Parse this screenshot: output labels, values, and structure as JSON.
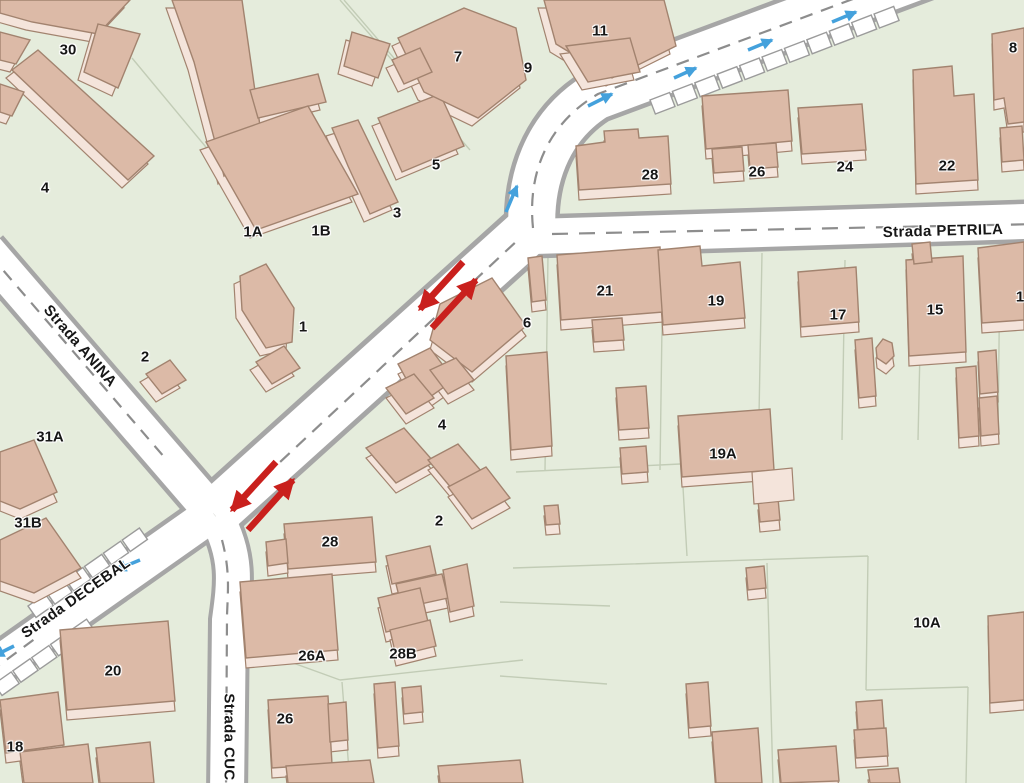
{
  "map": {
    "type": "street-map",
    "streets": {
      "anina": "Strada ANINA",
      "petrila": "Strada PETRILA",
      "decebal": "Strada DECEBAL",
      "cuc": "Strada CUC"
    },
    "building_labels": [
      {
        "t": "30",
        "x": 68,
        "y": 50
      },
      {
        "t": "4",
        "x": 45,
        "y": 188
      },
      {
        "t": "1A",
        "x": 253,
        "y": 232
      },
      {
        "t": "1B",
        "x": 321,
        "y": 231
      },
      {
        "t": "1",
        "x": 303,
        "y": 327
      },
      {
        "t": "2",
        "x": 145,
        "y": 357
      },
      {
        "t": "7",
        "x": 458,
        "y": 57
      },
      {
        "t": "9",
        "x": 528,
        "y": 68
      },
      {
        "t": "11",
        "x": 600,
        "y": 31
      },
      {
        "t": "5",
        "x": 436,
        "y": 165
      },
      {
        "t": "3",
        "x": 397,
        "y": 213
      },
      {
        "t": "28",
        "x": 650,
        "y": 175
      },
      {
        "t": "26",
        "x": 757,
        "y": 172
      },
      {
        "t": "24",
        "x": 845,
        "y": 167
      },
      {
        "t": "22",
        "x": 947,
        "y": 166
      },
      {
        "t": "8",
        "x": 1013,
        "y": 48
      },
      {
        "t": "6",
        "x": 527,
        "y": 323
      },
      {
        "t": "21",
        "x": 605,
        "y": 291
      },
      {
        "t": "19",
        "x": 716,
        "y": 301
      },
      {
        "t": "17",
        "x": 838,
        "y": 315
      },
      {
        "t": "15",
        "x": 935,
        "y": 310
      },
      {
        "t": "1",
        "x": 1020,
        "y": 297
      },
      {
        "t": "31A",
        "x": 50,
        "y": 437
      },
      {
        "t": "31B",
        "x": 28,
        "y": 523
      },
      {
        "t": "4",
        "x": 442,
        "y": 425
      },
      {
        "t": "2",
        "x": 439,
        "y": 521
      },
      {
        "t": "28",
        "x": 330,
        "y": 542
      },
      {
        "t": "19A",
        "x": 723,
        "y": 454
      },
      {
        "t": "20",
        "x": 113,
        "y": 671
      },
      {
        "t": "26A",
        "x": 312,
        "y": 656
      },
      {
        "t": "28B",
        "x": 403,
        "y": 654
      },
      {
        "t": "26",
        "x": 285,
        "y": 719
      },
      {
        "t": "10A",
        "x": 927,
        "y": 623
      },
      {
        "t": "18",
        "x": 15,
        "y": 747
      }
    ],
    "arrows": {
      "red_meaning": "two-way traffic marker pairs",
      "red": [
        {
          "x1": 463,
          "y1": 262,
          "x2": 420,
          "y2": 309
        },
        {
          "x1": 432,
          "y1": 328,
          "x2": 476,
          "y2": 280
        },
        {
          "x1": 276,
          "y1": 462,
          "x2": 232,
          "y2": 510
        },
        {
          "x1": 248,
          "y1": 530,
          "x2": 293,
          "y2": 480
        }
      ],
      "blue_meaning": "one-way direction markers",
      "blue": [
        {
          "x1": 506,
          "y1": 212,
          "x2": 517,
          "y2": 186
        },
        {
          "x1": 588,
          "y1": 106,
          "x2": 612,
          "y2": 94
        },
        {
          "x1": 674,
          "y1": 78,
          "x2": 696,
          "y2": 68
        },
        {
          "x1": 748,
          "y1": 50,
          "x2": 772,
          "y2": 40
        },
        {
          "x1": 832,
          "y1": 22,
          "x2": 856,
          "y2": 12
        },
        {
          "x1": 140,
          "y1": 560,
          "x2": 116,
          "y2": 570
        },
        {
          "x1": 14,
          "y1": 646,
          "x2": -6,
          "y2": 656
        }
      ]
    },
    "colors": {
      "ground": "#e5ecdc",
      "parcel_line": "#c2ccb6",
      "road_fill": "#ffffff",
      "road_casing": "#a6a6a6",
      "centerline": "#8d8d8d",
      "building_fill": "#dcbaa7",
      "building_light": "#f4e4db",
      "building_stroke": "#a2836f",
      "arrow_red": "#c9201d",
      "arrow_blue": "#44a1dc",
      "label": "#161616"
    }
  }
}
